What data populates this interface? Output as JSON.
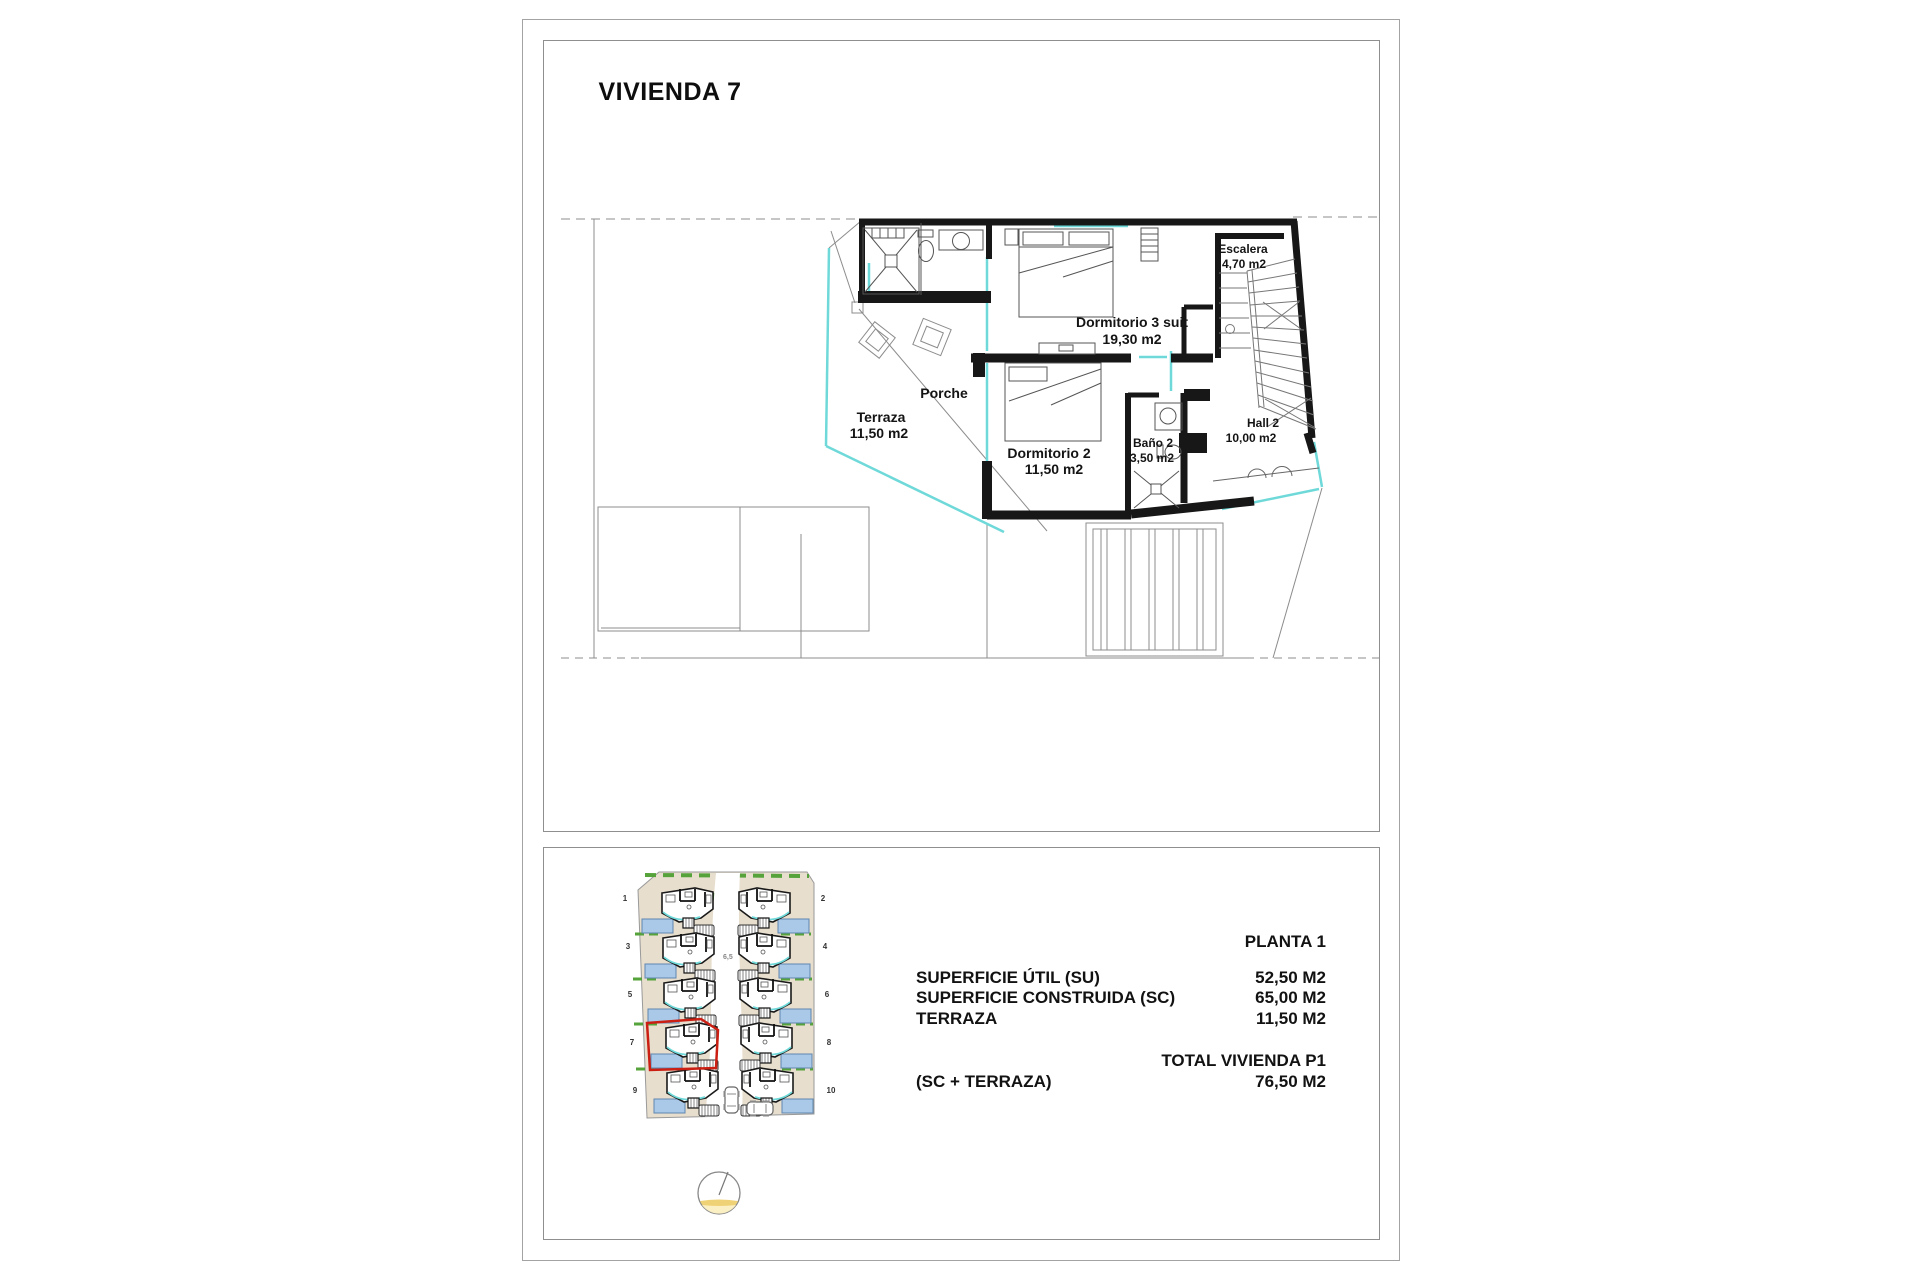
{
  "title": "VIVIENDA 7",
  "floorplan": {
    "rooms": {
      "terraza": {
        "name": "Terraza",
        "area": "11,50 m2"
      },
      "porche": {
        "name": "Porche",
        "area": ""
      },
      "dormitorio2": {
        "name": "Dormitorio 2",
        "area": "11,50 m2"
      },
      "dormitorio3": {
        "name": "Dormitorio 3 suit",
        "area": "19,30 m2"
      },
      "bano2": {
        "name": "Baño 2",
        "area": "3,50 m2"
      },
      "hall2": {
        "name": "Hall 2",
        "area": "10,00 m2"
      },
      "escalera": {
        "name": "Escalera",
        "area": "4,70 m2"
      }
    }
  },
  "site_plan": {
    "unit_numbers": [
      "1",
      "2",
      "3",
      "4",
      "5",
      "6",
      "7",
      "8",
      "9",
      "10"
    ],
    "highlighted_unit": "7",
    "road_label": "6,5"
  },
  "specs": {
    "floor_title": "PLANTA 1",
    "rows": [
      {
        "label": "SUPERFICIE ÚTIL (SU)",
        "value": "52,50 M2"
      },
      {
        "label": "SUPERFICIE CONSTRUIDA (SC)",
        "value": "65,00 M2"
      },
      {
        "label": "TERRAZA",
        "value": "11,50 M2"
      }
    ],
    "total_label": "TOTAL VIVIENDA P1",
    "total_sublabel": "(SC + TERRAZA)",
    "total_value": "76,50 M2"
  },
  "colors": {
    "wall": "#171717",
    "window_accent": "#6fd9d9",
    "thin_line": "#8c8c8c",
    "highlight_red": "#cc1f14",
    "pool_blue": "#aac9e8",
    "hedge_green": "#55a33a",
    "plot_beige": "#e7decd",
    "compass_yellow": "#f0d276"
  }
}
